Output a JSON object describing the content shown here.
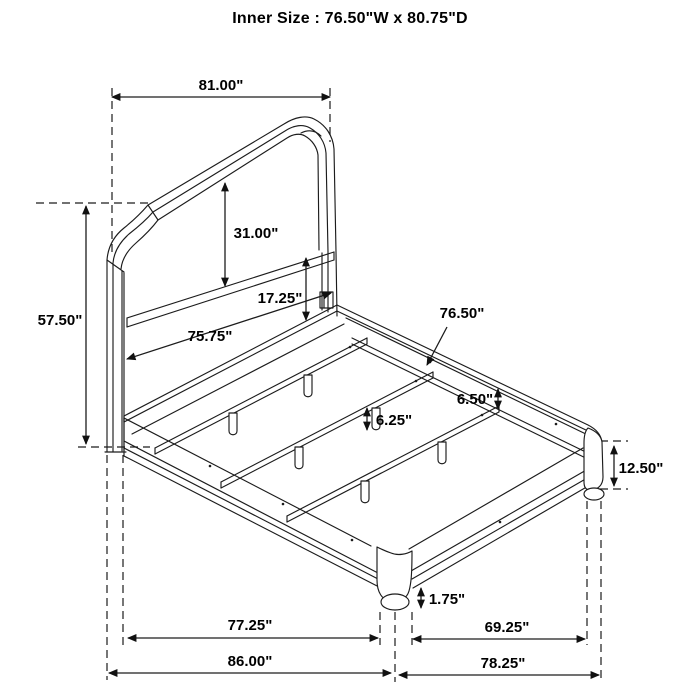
{
  "title": "Inner Size : 76.50\"W x 80.75\"D",
  "dimensions": {
    "headboard_width": "81.00\"",
    "total_height": "57.50\"",
    "headboard_panel_height": "31.00\"",
    "panel_to_rail_gap": "17.25\"",
    "headboard_inner_width": "75.75\"",
    "slat_width": "76.50\"",
    "rail_top_to_cleat": "6.50\"",
    "slat_leg_height": "6.25\"",
    "side_rail_height": "12.50\"",
    "foot_height": "1.75\"",
    "frame_depth": "77.25\"",
    "overall_depth": "86.00\"",
    "footboard_inner_width": "69.25\"",
    "overall_width": "78.25\""
  }
}
